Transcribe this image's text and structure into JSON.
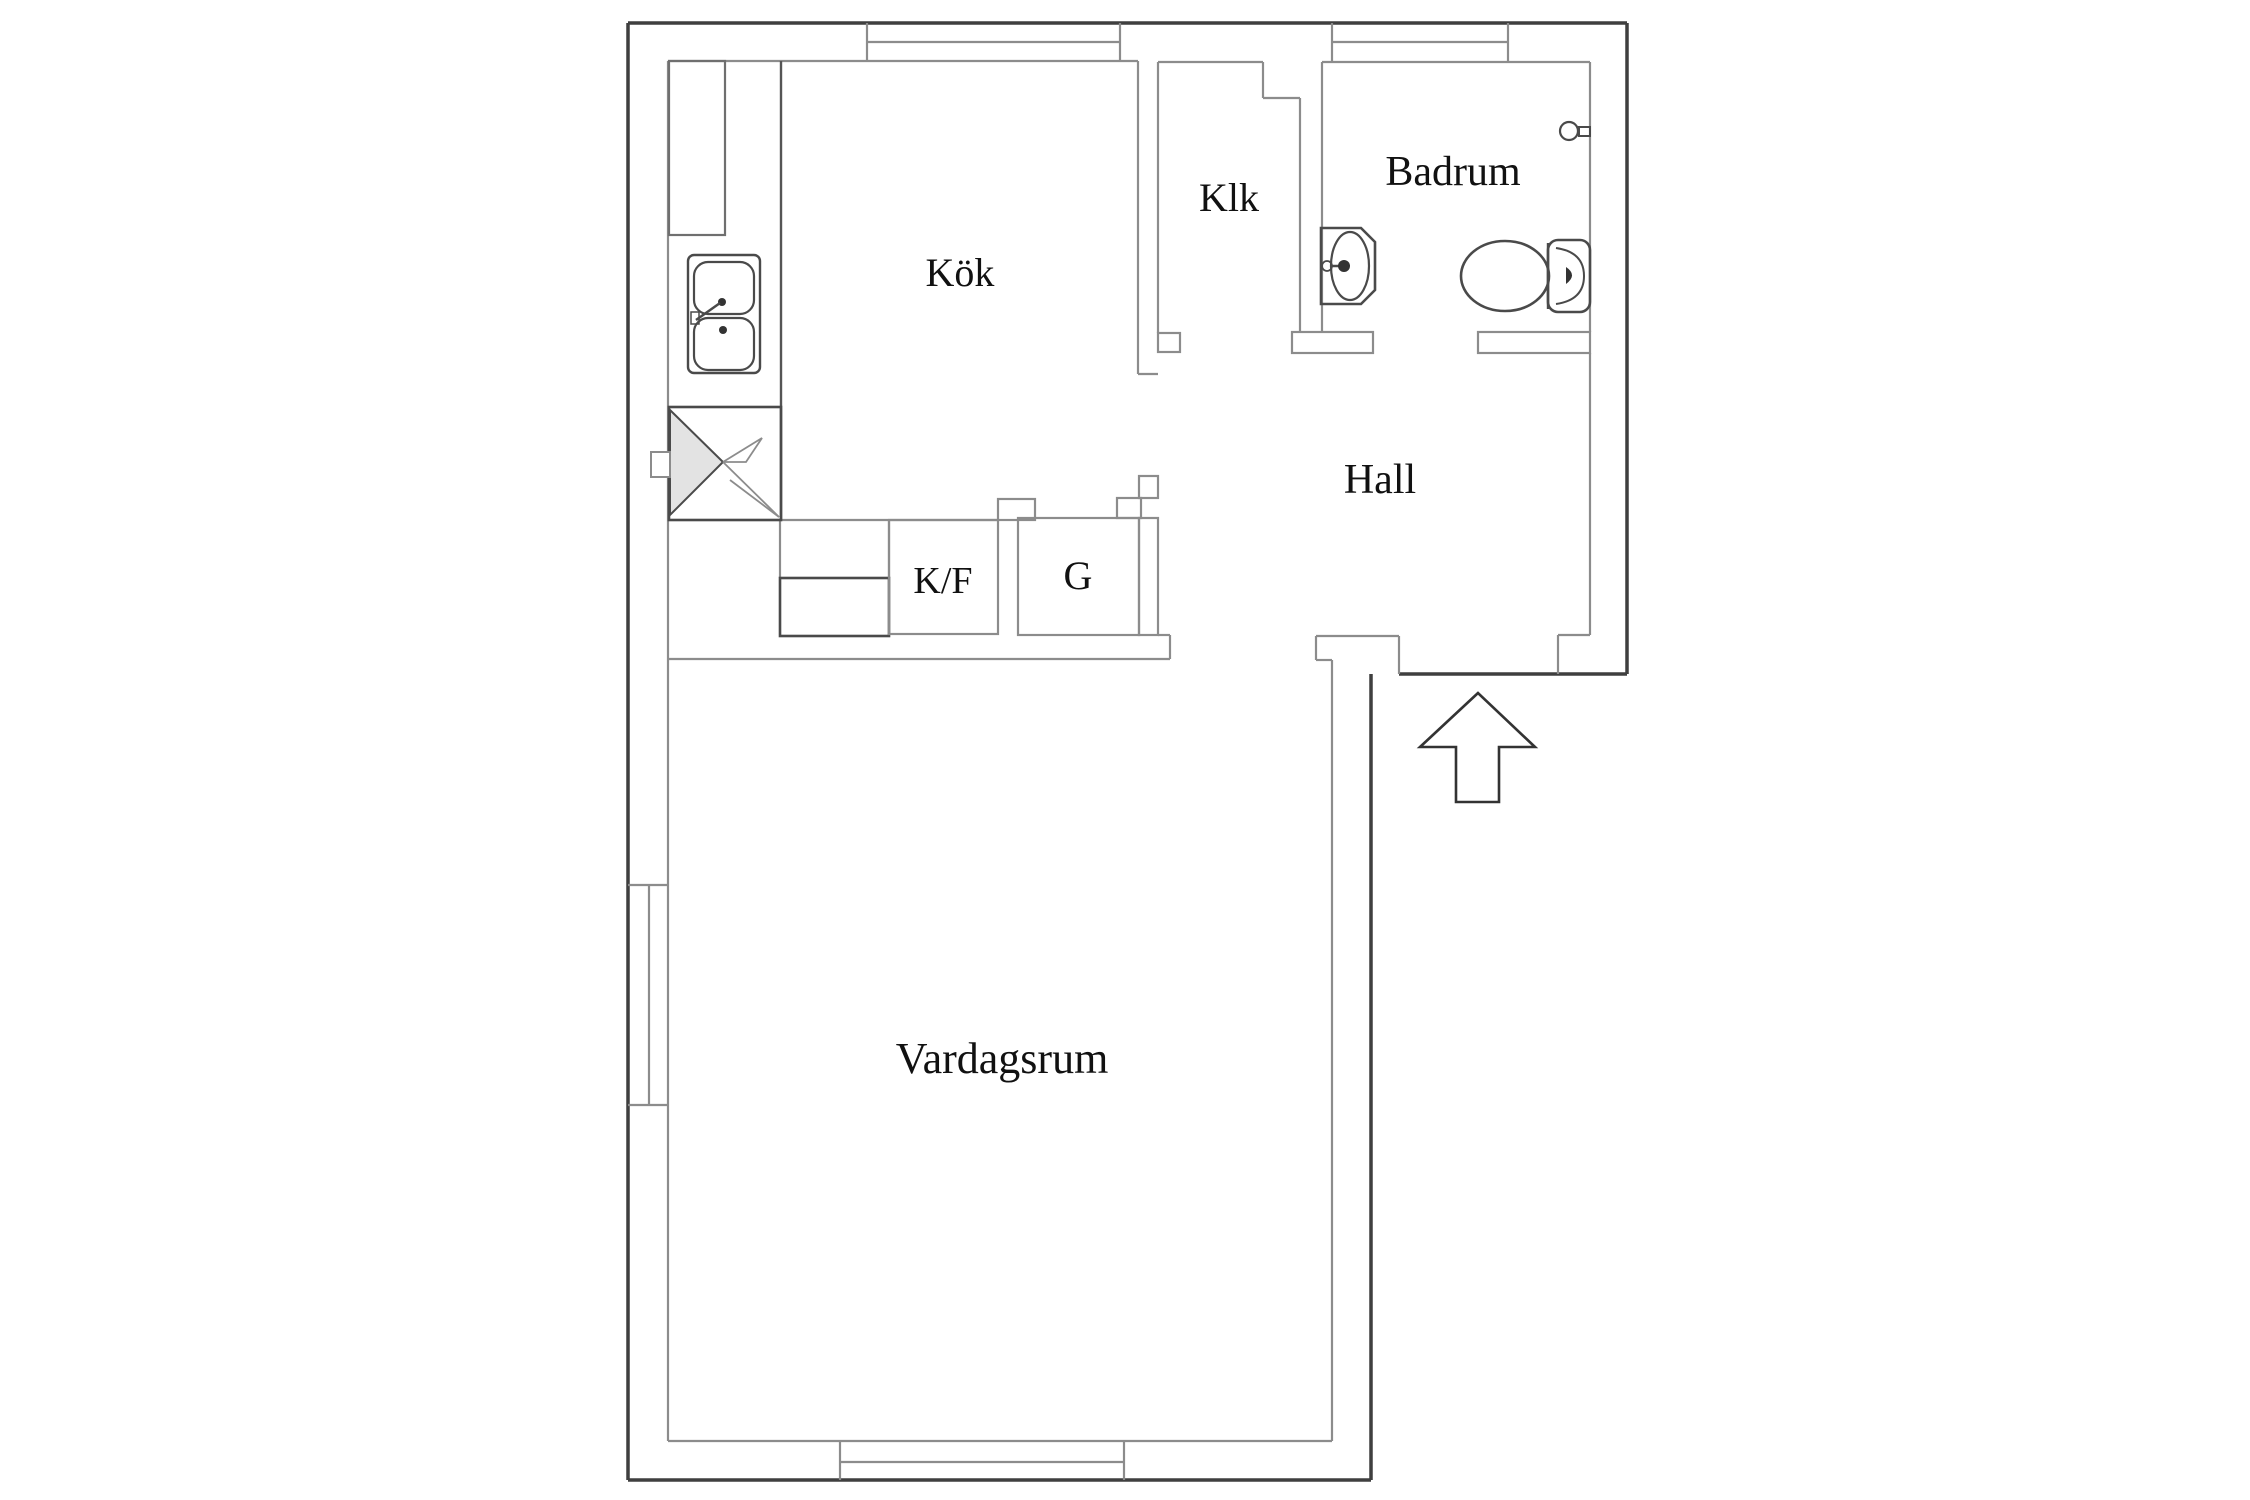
{
  "plan": {
    "title": "apartment-floor-plan",
    "rooms": {
      "kok": {
        "label": "Kök"
      },
      "klk": {
        "label": "Klk"
      },
      "badrum": {
        "label": "Badrum"
      },
      "hall": {
        "label": "Hall"
      },
      "kf": {
        "label": "K/F"
      },
      "g": {
        "label": "G"
      },
      "vardagsrum": {
        "label": "Vardagsrum"
      }
    },
    "fixtures": [
      "kitchen-cabinet",
      "kitchen-sink",
      "stove-corner-unit",
      "appliance-box",
      "bathroom-sink",
      "toilet",
      "towel-ring",
      "entrance-arrow"
    ],
    "colors": {
      "outer_wall": "#3f3f3f",
      "inner_wall": "#8c8c8c",
      "fixture_dark": "#4a4a4a",
      "fixture_fill": "#e3e3e3",
      "text": "#111111",
      "background": "#ffffff"
    }
  }
}
